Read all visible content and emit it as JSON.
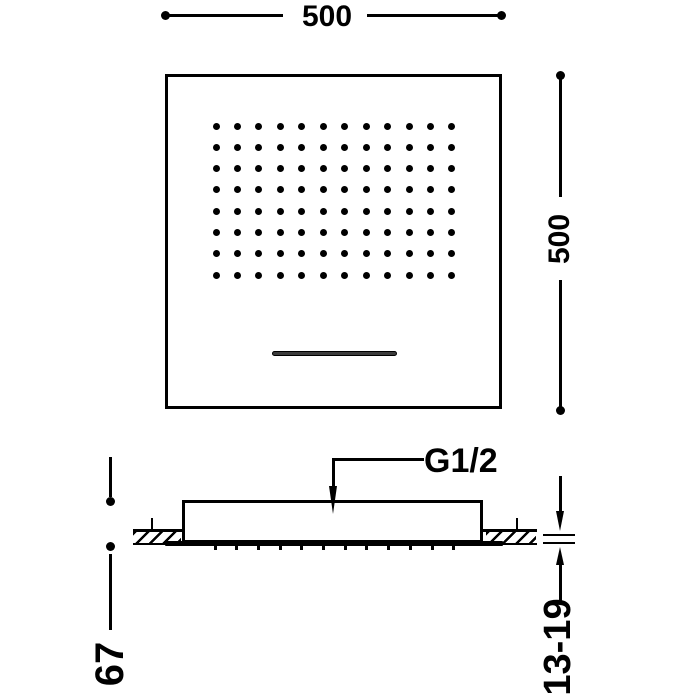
{
  "drawing": {
    "dimensions": {
      "width": "500",
      "depth": "500",
      "body_height": "67",
      "ceiling_range": "13-19"
    },
    "connection": {
      "thread_label": "G1/2"
    },
    "front_view": {
      "nozzle_rows": 8,
      "nozzle_cols": 12
    },
    "side_view": {
      "nozzle_tick_count": 12
    },
    "colors": {
      "line": "#000000",
      "background": "#ffffff",
      "slot_fill": "#3c3c3c"
    }
  }
}
